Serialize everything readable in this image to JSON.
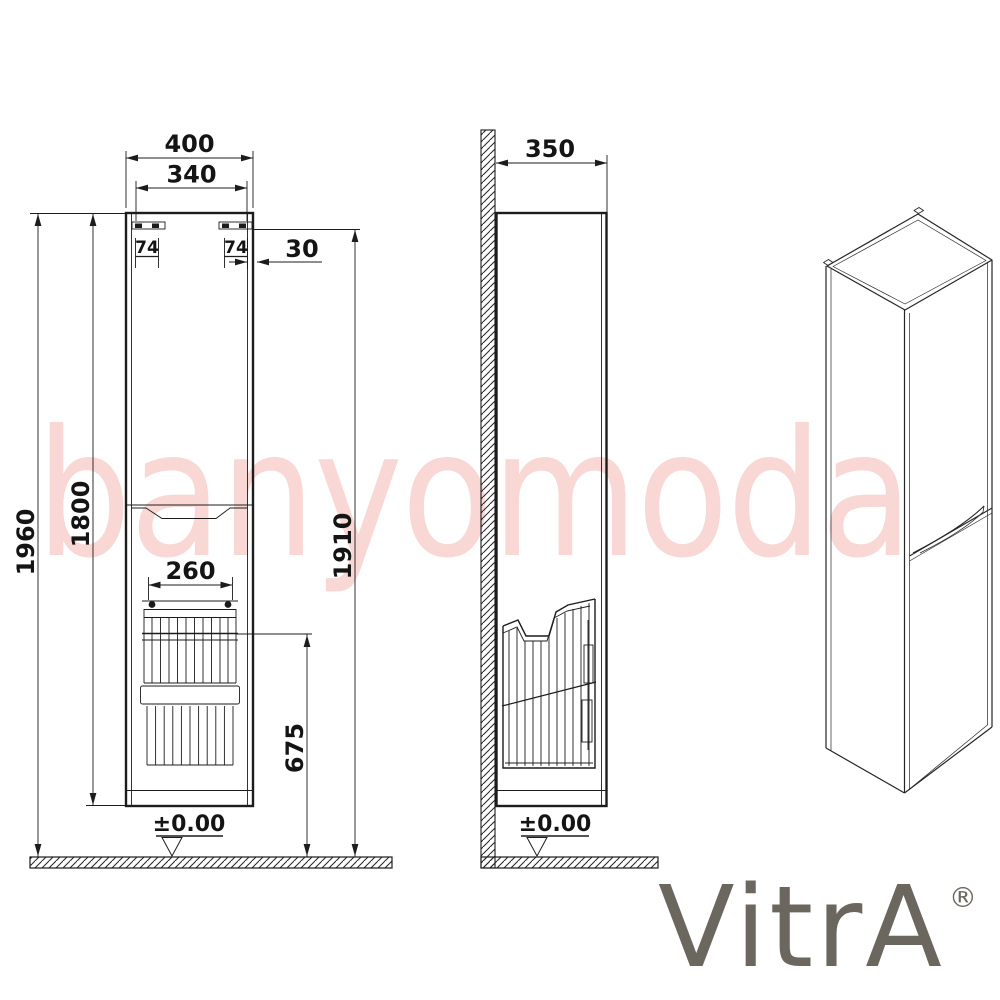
{
  "watermark": {
    "text": "banyomoda",
    "color": "#f8d7d4"
  },
  "brand": {
    "name": "VitrA",
    "registered_mark": "®",
    "color": "#6b675f"
  },
  "drawing": {
    "line_color": "#1c1c1c",
    "front_view": {
      "width_total": "400",
      "width_inner": "340",
      "bracket_left": "74",
      "bracket_right": "74",
      "top_offset": "30",
      "height_total": "1960",
      "height_body": "1800",
      "basket_width": "260",
      "basket_rim_height": "675",
      "floor_datum": "±0.00"
    },
    "side_view": {
      "depth": "350",
      "height_to_bracket": "1910",
      "floor_datum": "±0.00"
    }
  }
}
